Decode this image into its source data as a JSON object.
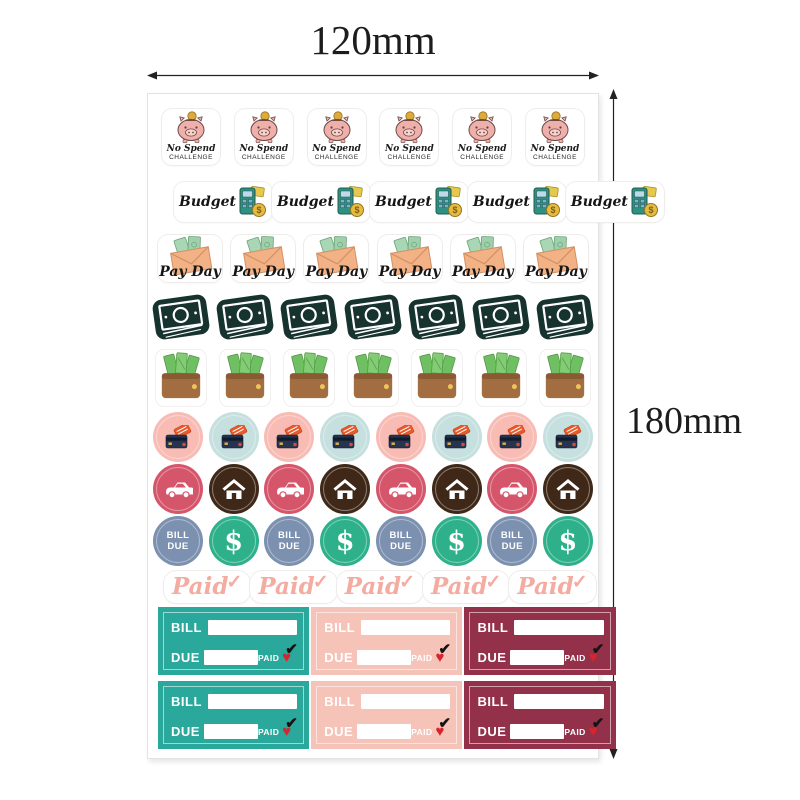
{
  "annotations": {
    "width_label": "120mm",
    "height_label": "180mm",
    "arrow_color": "#222222"
  },
  "sheet": {
    "background": "#ffffff",
    "no_spend_row": {
      "count": 6,
      "icon": "piggy-bank-icon",
      "title": "No Spend",
      "subtitle": "CHALLENGE"
    },
    "budget_row": {
      "count": 5,
      "icon": "calculator-coin-icon",
      "label": "Budget",
      "coin_symbol": "$"
    },
    "payday_row": {
      "count": 6,
      "icon": "envelope-cash-icon",
      "label": "Pay Day"
    },
    "cash_row": {
      "count": 7,
      "icon": "banknote-stack-icon",
      "color": "#17332e"
    },
    "wallet_row": {
      "count": 7,
      "icon": "wallet-cash-icon"
    },
    "card_row": {
      "count": 8,
      "pairs": 4,
      "icon": "credit-cards-icon",
      "bg_pink": "#f8bcb4",
      "bg_blue": "#c5e0df"
    },
    "vehicle_home_row": {
      "count": 8,
      "pairs": 4,
      "car_bg": "#d5566b",
      "house_bg": "#3f2817"
    },
    "bill_dollar_row": {
      "count": 8,
      "pairs": 4,
      "bill_text_1": "BILL",
      "bill_text_2": "DUE",
      "dollar_text": "$",
      "bill_bg": "#7c90b0",
      "dollar_bg": "#2eb18b"
    },
    "paid_row": {
      "count": 5,
      "label": "Paid",
      "check": "✓",
      "color": "#f4aba0"
    },
    "bill_slip_rows": 2,
    "bill_slip": {
      "bill_label": "BILL",
      "due_label": "DUE",
      "paid_label": "PAID",
      "heart": "♥",
      "check": "✔",
      "colors": [
        "#29a89b",
        "#f6c3b8",
        "#93304a"
      ]
    }
  }
}
